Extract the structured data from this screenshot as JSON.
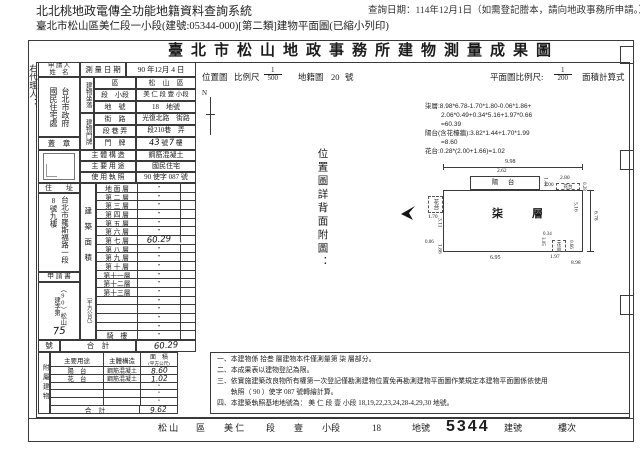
{
  "header": {
    "system_title": "北北桃地政電傳全功能地籍資料查詢系統",
    "query_date": "查詢日期：114年12月1日（如需登記謄本，請向地政事務所申請。）",
    "subtitle": "臺北市松山區美仁段一小段(建號:05344-000)[第二類]建物平面圖(已縮小列印)"
  },
  "doc": {
    "title": "臺北市松山地政事務所建物測量成果圖",
    "margin_note": "右代理人：",
    "applicant": {
      "label_line1": "申 請 人",
      "label_line2": "姓　名",
      "name_col_right": "台北市政府",
      "name_col_left": "國民住宅處",
      "seal_label": "蓋　章"
    },
    "survey": {
      "label": "測 量 日 期",
      "value": "90 年12月 4 日"
    },
    "location": {
      "group_label": "建物坐落",
      "rows": [
        {
          "label": "區",
          "value": "松　山　區"
        },
        {
          "label": "段　小段",
          "value": "美 仁 段 壹 小段"
        },
        {
          "label": "地　號",
          "value": "18　地號"
        }
      ]
    },
    "address_plate": {
      "group_label": "建物門牌",
      "rows": [
        {
          "label": "街　路",
          "value": "光復北路　街路"
        },
        {
          "label": "段 巷 弄",
          "value": "段210巷　弄"
        }
      ],
      "plate_label": "門　牌",
      "plate": {
        "h1": "43",
        "t1": "號",
        "h2": "7",
        "t2": "樓"
      }
    },
    "structure": {
      "label": "主 體 構 造",
      "value": "鋼筋混凝土"
    },
    "usage": {
      "label": "主 要 用 途",
      "value": "國民住宅"
    },
    "license": {
      "label": "使 用 執 照",
      "value": "90 使字 087 號"
    },
    "residence": {
      "label": "住　　址",
      "col_right": "台北市羅斯福路一段",
      "col_left": "8號九樓"
    },
    "application": {
      "label": "申 請 書",
      "case_no": "（90）松山建字第",
      "hand_no": "75",
      "suffix": "號"
    },
    "areas": {
      "group_label": "建築面積",
      "group_unit": "（平方公尺）",
      "floors": [
        {
          "label": "地 面 層",
          "value": "•"
        },
        {
          "label": "第 二 層",
          "value": "•"
        },
        {
          "label": "第 三 層",
          "value": "•"
        },
        {
          "label": "第 四 層",
          "value": "•"
        },
        {
          "label": "第 五 層",
          "value": "•"
        },
        {
          "label": "第 六 層",
          "value": "•"
        },
        {
          "label": "第 七 層",
          "value": "60.29"
        },
        {
          "label": "第 八 層",
          "value": "•"
        },
        {
          "label": "第 九 層",
          "value": "•"
        },
        {
          "label": "第 十 層",
          "value": "•"
        },
        {
          "label": "第十一層",
          "value": "•"
        },
        {
          "label": "第十二層",
          "value": "•"
        },
        {
          "label": "第十三層",
          "value": "•"
        },
        {
          "label": "",
          "value": "•"
        },
        {
          "label": "",
          "value": "•"
        },
        {
          "label": "",
          "value": "•"
        },
        {
          "label": "",
          "value": "•"
        },
        {
          "label": "騎　樓",
          "value": "•"
        }
      ],
      "row_no_label": "號",
      "total_label": "合　計",
      "total_value": "60.29"
    },
    "annex": {
      "group_label": "附屬建物",
      "headers": [
        "主要用途",
        "主體構造",
        "面　積",
        "(平方公尺)"
      ],
      "rows": [
        {
          "use": "陽　台",
          "structure": "鋼筋混凝土",
          "area": "8.60"
        },
        {
          "use": "花　台",
          "structure": "鋼筋混凝土",
          "area": "1.02"
        },
        {
          "use": "",
          "structure": "",
          "area": "•"
        },
        {
          "use": "",
          "structure": "",
          "area": "•"
        },
        {
          "use": "",
          "structure": "",
          "area": "•"
        }
      ],
      "total_label": "合　計",
      "total_value": "9.62"
    },
    "scales": {
      "loc_label": "位置圖",
      "loc_scale_label": "比例尺",
      "loc_num": "1",
      "loc_den": "500",
      "map_label": "地籍圖",
      "map_no": "20",
      "map_unit": "號",
      "north": "N",
      "plan_label": "平面圖比例尺:",
      "plan_num": "1",
      "plan_den": "200",
      "calc_label": "面積計算式"
    },
    "calc_lines": [
      "柒層:8.98*6.78-1.70*1.80-0.06*1.86+",
      "2.06*0.49+0.34*5.16+1.97*0.66",
      "=60.39",
      "陽台(含花檯牆):3.82*1.44+1.70*1.99",
      "=8.60",
      "花台:0.28*(2.00+1.66)=1.02"
    ],
    "back_note": "位置圖詳背面附圖：",
    "plan": {
      "floor_label": "柒　層",
      "balcony_label": "陽 台",
      "flower_left_label": "花台",
      "flower_right_label": "花台",
      "flower_bottom_label": "花台",
      "dims": {
        "top": "9.98",
        "balcony_w": "2.62",
        "balcony_h": "1.44",
        "seg": "2.00",
        "fr_w": "2.80",
        "fr_h": "0.28",
        "right_inner": "5.16",
        "right_outer": "6.78",
        "left_upper": "3.11",
        "left_small": "0.06",
        "left_lower": "1.86",
        "fl_w": "1.70",
        "bottom_left": "6.95",
        "b_305": "3.05",
        "b_034": "0.34",
        "b_197": "1.97",
        "b_066": "0.66",
        "b_898": "8.98"
      }
    },
    "notes": [
      "一、本建物係 拾叁 層建物本件僅測量第 柒 層部分。",
      "二、本成果表以建物登記為限。",
      "三、依實施建築改良物所有權第一次登記僅勘測建物位置免再勘測建物平面圖作業規定本建物平面圖係依使用",
      "　　執照（ 90 ）使字 087 號轉繪計算。",
      "四、本建築執照基地地號為： 美 仁 段 壹 小段 18,19,22,23,24,28-4,29,30 地號。"
    ],
    "footer": {
      "items": [
        "松 山",
        "區",
        "美 仁",
        "段",
        "壹",
        "小段",
        "18",
        "地號",
        "5344",
        "建號",
        "樓次"
      ]
    }
  }
}
